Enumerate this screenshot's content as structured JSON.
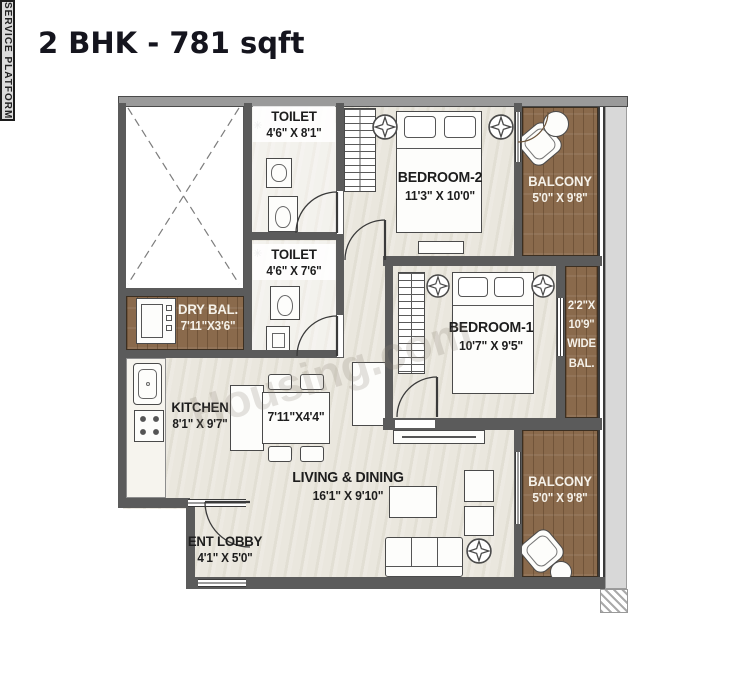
{
  "title": "2 BHK - 781 sqft",
  "watermark": "Housing.com",
  "rooms": {
    "toilet1": {
      "name": "TOILET",
      "dims": "4'6\" X 8'1\""
    },
    "bedroom2": {
      "name": "BEDROOM-2",
      "dims": "11'3\" X 10'0\""
    },
    "balcony_top": {
      "name": "BALCONY",
      "dims": "5'0\" X 9'8\""
    },
    "service_platform": {
      "name": "SERVICE PLATFORM"
    },
    "dry_balcony": {
      "name": "DRY BAL.",
      "dims": "7'11\"X3'6\""
    },
    "toilet2": {
      "name": "TOILET",
      "dims": "4'6\" X 7'6\""
    },
    "bedroom1": {
      "name": "BEDROOM-1",
      "dims": "10'7\" X 9'5\""
    },
    "wide_balcony": {
      "line1": "2'2\"X",
      "line2": "10'9\"",
      "line3": "WIDE",
      "line4": "BAL."
    },
    "kitchen": {
      "name": "KITCHEN",
      "dims": "8'1\" X 9'7\""
    },
    "dining": {
      "dims": "7'11\"X4'4\""
    },
    "living": {
      "name": "LIVING & DINING",
      "dims": "16'1\" X 9'10\""
    },
    "ent_lobby": {
      "name": "ENT LOBBY",
      "dims": "4'1\" X 5'0\""
    },
    "balcony_bottom": {
      "name": "BALCONY",
      "dims": "5'0\" X 9'8\""
    }
  },
  "icons": {
    "shower": "✳"
  },
  "colors": {
    "wall": "#5b5b5b",
    "wall_light": "#9a9a9a",
    "floor": "#eae7de",
    "wood": "#8a6a4c",
    "ledge": "#d8d8d8",
    "line": "#3a3a3a",
    "text": "#1d1d1d",
    "text_light": "#f5f1e9"
  }
}
